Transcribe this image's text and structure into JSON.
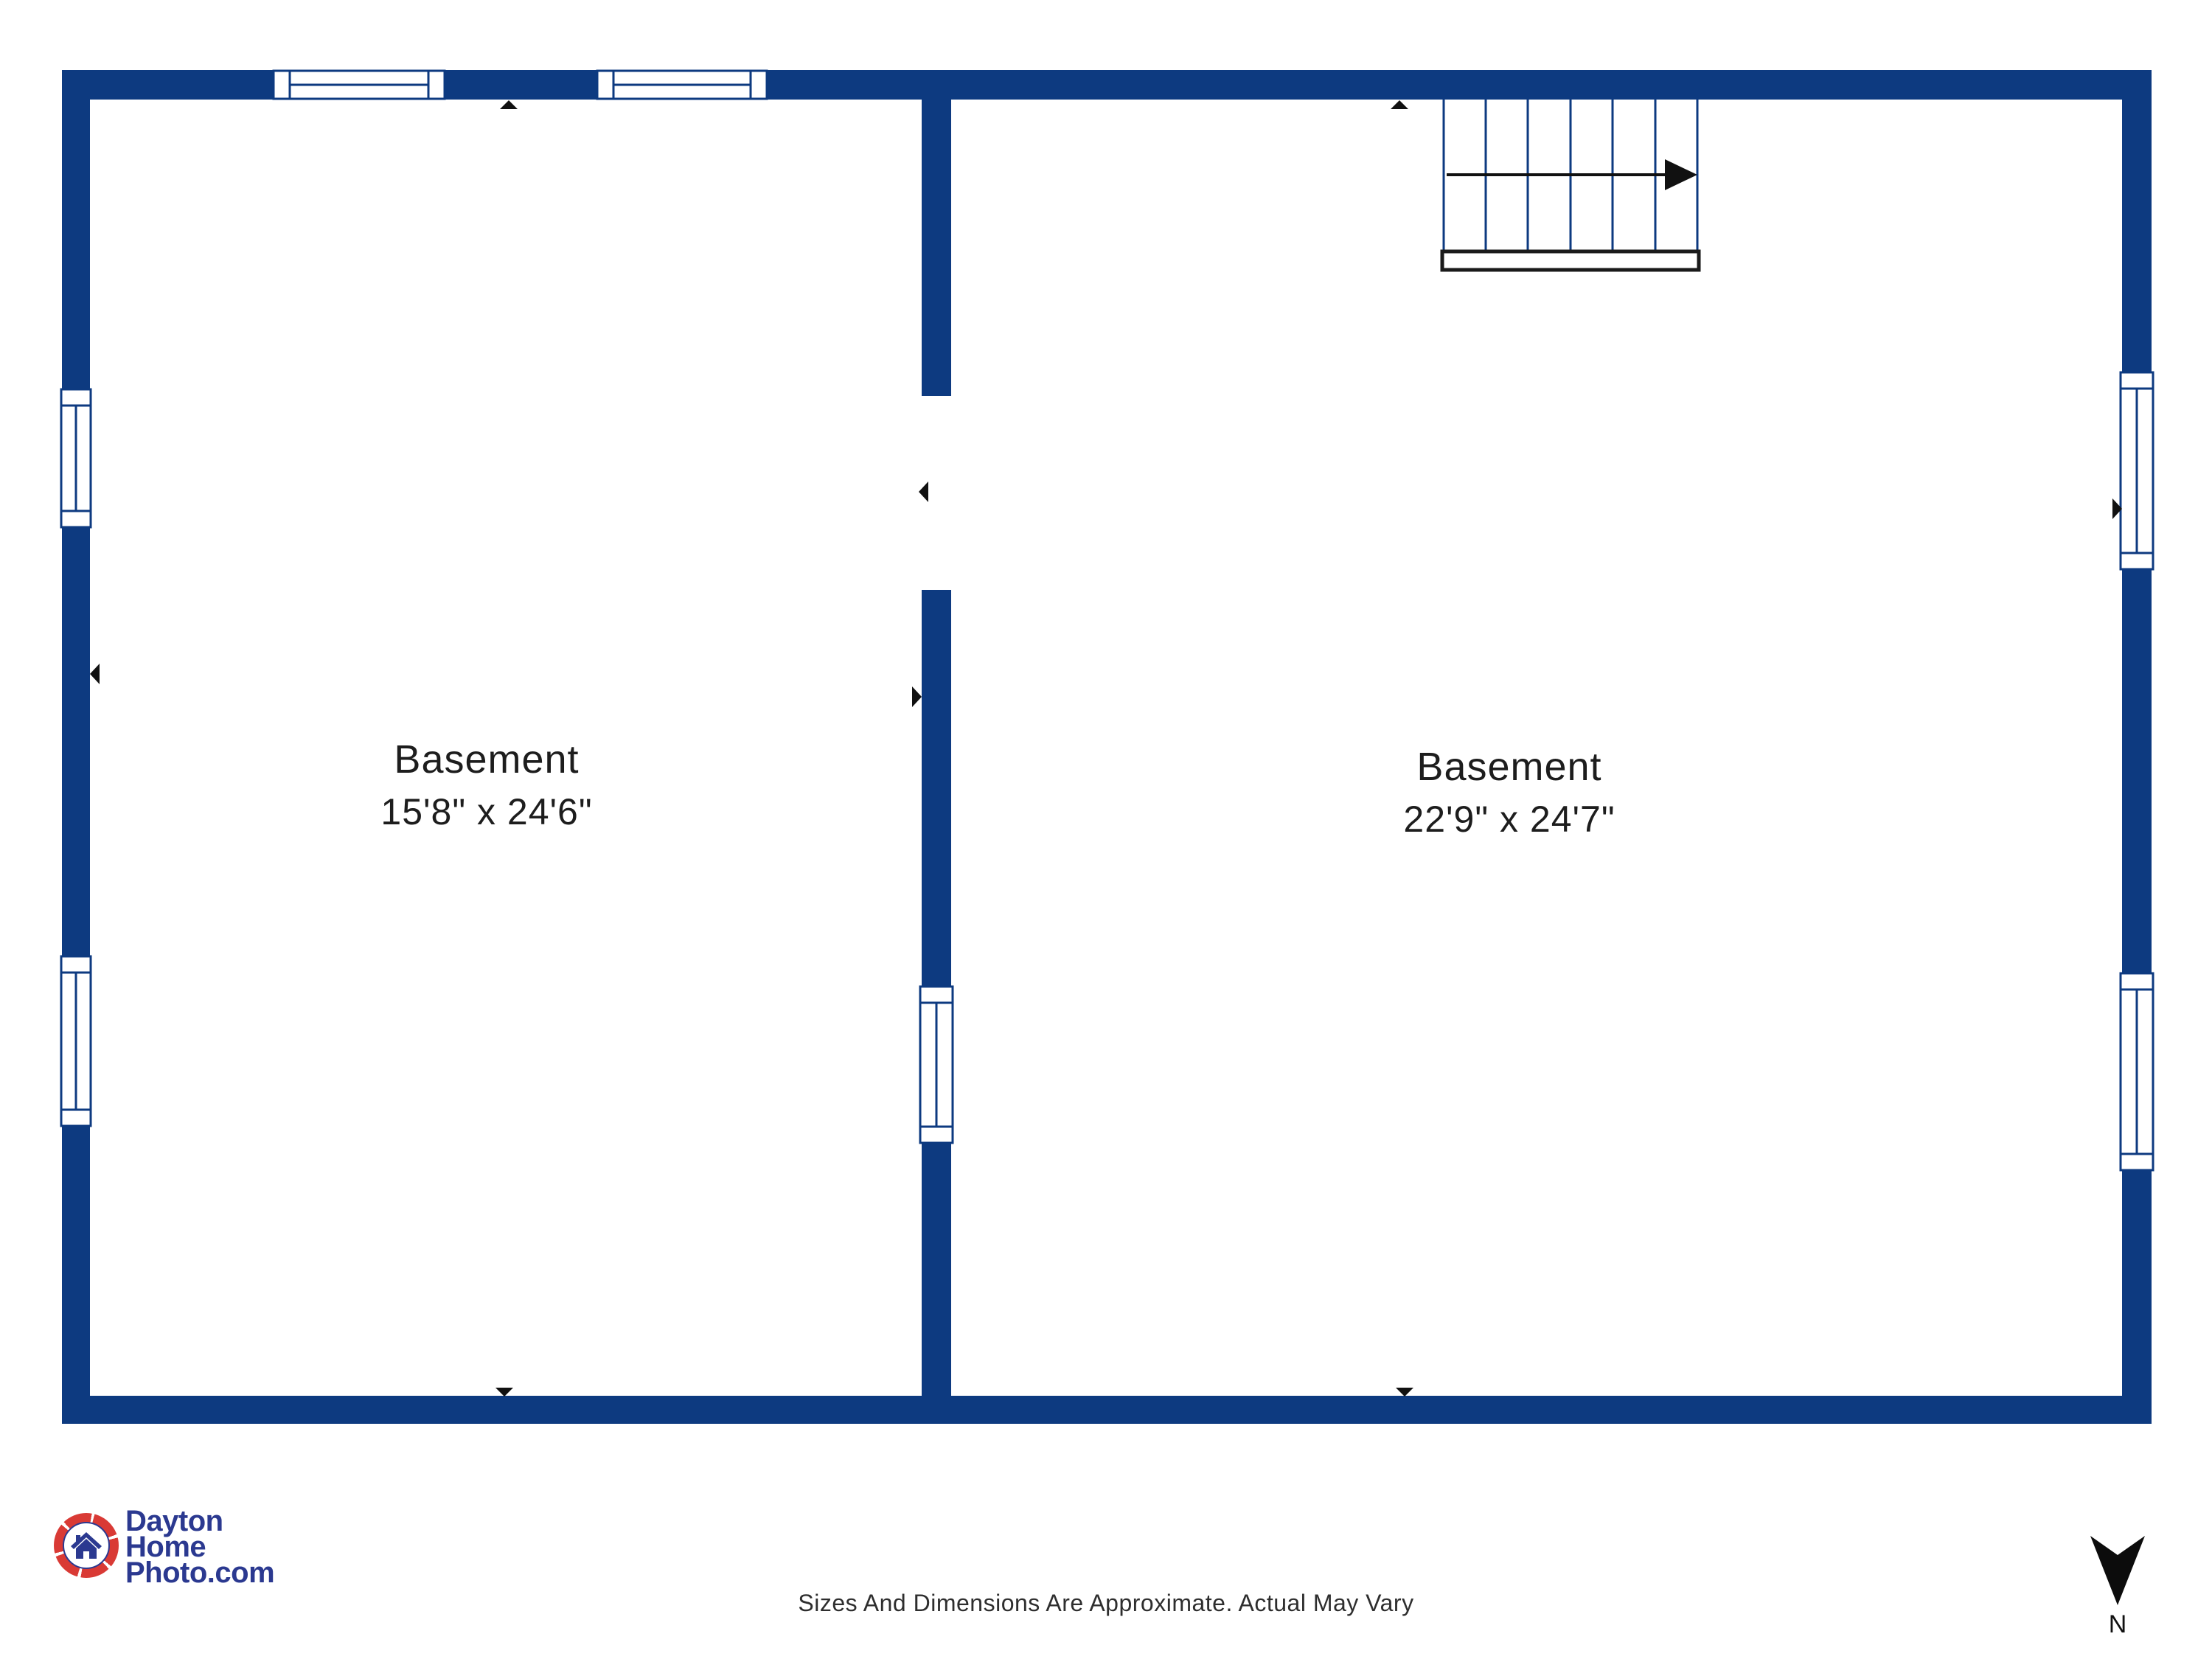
{
  "plan": {
    "rooms": [
      {
        "name": "Basement",
        "dimensions": "15'8\" x 24'6\""
      },
      {
        "name": "Basement",
        "dimensions": "22'9\" x 24'7\""
      }
    ]
  },
  "footer": {
    "disclaimer": "Sizes And Dimensions Are Approximate. Actual May Vary"
  },
  "logo": {
    "line1": "Dayton",
    "line2": "Home",
    "line3": "Photo.com"
  },
  "compass": {
    "label": "N"
  },
  "colors": {
    "wall": "#0d3a80",
    "logo-blue": "#2b3990",
    "logo-red": "#d93a35",
    "marker": "#111111",
    "text": "#1d1d1d"
  }
}
